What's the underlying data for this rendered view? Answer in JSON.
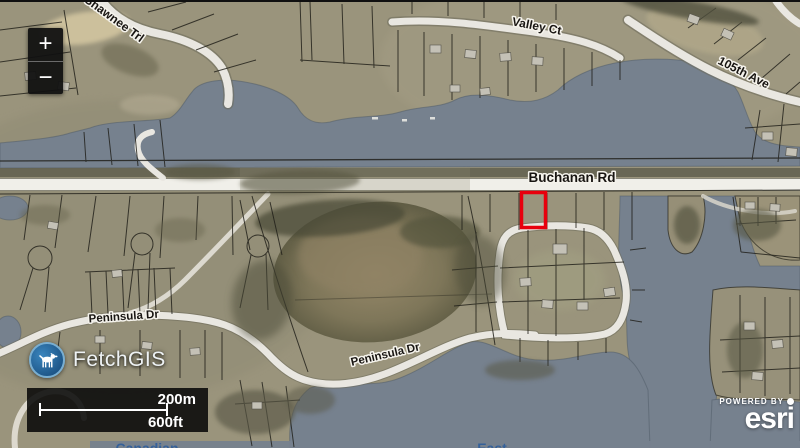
{
  "map": {
    "road_labels": [
      {
        "id": "shawnee-trl",
        "text": "Shawnee Trl"
      },
      {
        "id": "valley-ct",
        "text": "Valley Ct"
      },
      {
        "id": "105th-ave",
        "text": "105th Ave"
      },
      {
        "id": "buchanan-rd",
        "text": "Buchanan Rd"
      },
      {
        "id": "peninsula-dr-west",
        "text": "Peninsula Dr"
      },
      {
        "id": "peninsula-dr-east",
        "text": "Peninsula Dr"
      }
    ],
    "water_labels": [
      {
        "id": "lake-label-left",
        "text": "Canadian"
      },
      {
        "id": "lake-label-center",
        "text": "East"
      }
    ],
    "selection_color": "#e8000d"
  },
  "controls": {
    "zoom_in": "+",
    "zoom_out": "−"
  },
  "logo": {
    "title": "FetchGIS",
    "brand_color": "#2f79b2"
  },
  "scalebar": {
    "metric": "200m",
    "imperial": "600ft"
  },
  "attribution": {
    "powered_by": "POWERED BY",
    "brand": "esri"
  }
}
